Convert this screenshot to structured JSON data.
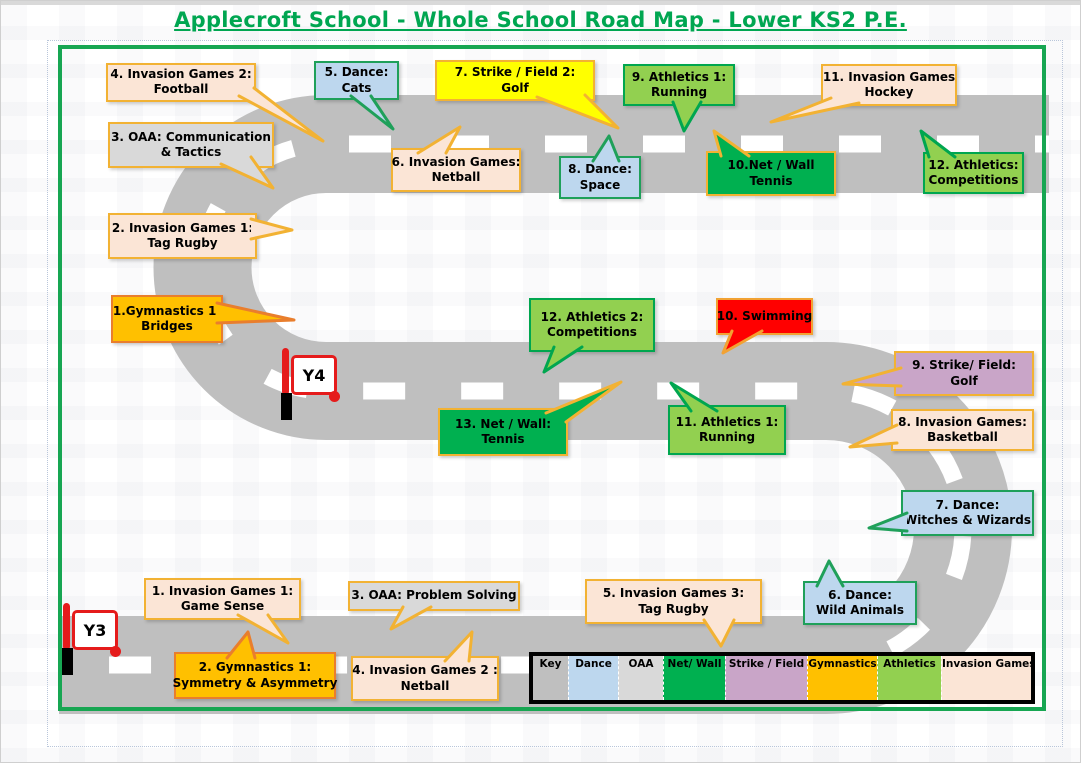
{
  "title": "Applecroft School - Whole School Road Map - Lower KS2 P.E.",
  "colors": {
    "title": "#00A651",
    "map_border": "#17A652",
    "road": "#BFBFBF",
    "road_dash": "#FFFFFF",
    "flag_red": "#E51B1B"
  },
  "categories": {
    "invasion": {
      "label": "Invasion Games",
      "fill": "#FBE5D6",
      "border": "#F2B233"
    },
    "dance": {
      "label": "Dance",
      "fill": "#BDD7EE",
      "border": "#1FA05A"
    },
    "oaa": {
      "label": "OAA",
      "fill": "#D9D9D9",
      "border": "#F2B233"
    },
    "netwall": {
      "label": "Net/ Wall",
      "fill": "#00B050",
      "border": "#F2B233"
    },
    "strike2": {
      "label": "Strike / Field",
      "fill": "#FFFF00",
      "border": "#F2B233"
    },
    "strike": {
      "label": "Strike / Field",
      "fill": "#C9A5C8",
      "border": "#F2B233"
    },
    "gymnastics": {
      "label": "Gymnastics",
      "fill": "#FFC000",
      "border": "#E97E2D"
    },
    "athletics": {
      "label": "Athletics",
      "fill": "#92D050",
      "border": "#00A64F"
    },
    "swimming": {
      "label": "Swimming",
      "fill": "#FF0000",
      "border": "#F2A233"
    }
  },
  "flags": [
    {
      "label": "Y4",
      "x": 281,
      "y": 347
    },
    {
      "label": "Y3",
      "x": 62,
      "y": 602
    }
  ],
  "legend": {
    "items": [
      {
        "label": "Key",
        "fill": "#BFBFBF",
        "w": 35
      },
      {
        "label": "Dance",
        "fill": "#BDD7EE",
        "w": 50
      },
      {
        "label": "OAA",
        "fill": "#D9D9D9",
        "w": 45
      },
      {
        "label": "Net/ Wall",
        "fill": "#00B050",
        "w": 62
      },
      {
        "label": "Strike / Field",
        "fill": "#C9A5C8",
        "w": 82
      },
      {
        "label": "Gymnastics",
        "fill": "#FFC000",
        "w": 70
      },
      {
        "label": "Athletics",
        "fill": "#92D050",
        "w": 64
      },
      {
        "label": "Invasion Games",
        "fill": "#FBE5D6",
        "w": 90
      }
    ]
  },
  "callouts": [
    {
      "id": "invasion-games-2-football",
      "category": "invasion",
      "x": 105,
      "y": 62,
      "w": 150,
      "h": 38,
      "lines": [
        "4. Invasion Games 2:",
        "Football"
      ],
      "tail": [
        238,
        95,
        253,
        87,
        322,
        140
      ]
    },
    {
      "id": "dance-cats",
      "category": "dance",
      "x": 313,
      "y": 60,
      "w": 85,
      "h": 39,
      "lines": [
        "5. Dance:",
        "Cats"
      ],
      "tail": [
        350,
        95,
        370,
        95,
        392,
        128
      ]
    },
    {
      "id": "strike-field-2-golf",
      "category": "strike2",
      "x": 434,
      "y": 59,
      "w": 160,
      "h": 41,
      "lines": [
        "7. Strike / Field 2:",
        "Golf"
      ],
      "tail": [
        536,
        96,
        584,
        94,
        617,
        127
      ]
    },
    {
      "id": "athletics-1-running-top",
      "category": "athletics",
      "x": 622,
      "y": 63,
      "w": 112,
      "h": 42,
      "lines": [
        "9. Athletics 1:",
        "Running"
      ],
      "tail": [
        672,
        101,
        700,
        101,
        683,
        130
      ]
    },
    {
      "id": "invasion-games-hockey",
      "category": "invasion",
      "x": 820,
      "y": 63,
      "w": 136,
      "h": 42,
      "lines": [
        "11. Invasion Games",
        "Hockey"
      ],
      "tail": [
        830,
        97,
        858,
        102,
        770,
        121
      ]
    },
    {
      "id": "oaa-communication-tactics",
      "category": "oaa",
      "x": 107,
      "y": 121,
      "w": 166,
      "h": 46,
      "lines": [
        "3. OAA: Communication",
        "& Tactics"
      ],
      "tail": [
        220,
        163,
        250,
        156,
        272,
        187
      ]
    },
    {
      "id": "invasion-games-netball-top",
      "category": "invasion",
      "x": 390,
      "y": 147,
      "w": 130,
      "h": 44,
      "lines": [
        "6. Invasion Games:",
        "Netball"
      ],
      "tail": [
        417,
        152,
        445,
        152,
        459,
        126
      ]
    },
    {
      "id": "dance-space",
      "category": "dance",
      "x": 558,
      "y": 155,
      "w": 82,
      "h": 43,
      "lines": [
        "8. Dance:",
        "Space"
      ],
      "tail": [
        592,
        160,
        618,
        160,
        608,
        135
      ]
    },
    {
      "id": "net-wall-tennis-top",
      "category": "netwall",
      "x": 705,
      "y": 150,
      "w": 130,
      "h": 45,
      "lines": [
        "10.Net / Wall",
        "Tennis"
      ],
      "tail": [
        720,
        155,
        748,
        155,
        713,
        130
      ]
    },
    {
      "id": "athletics-competitions-top",
      "category": "athletics",
      "x": 922,
      "y": 151,
      "w": 101,
      "h": 42,
      "lines": [
        "12. Athletics:",
        "Competitions"
      ],
      "tail": [
        928,
        156,
        954,
        156,
        920,
        130
      ]
    },
    {
      "id": "invasion-games-1-tag-rugby",
      "category": "invasion",
      "x": 107,
      "y": 212,
      "w": 149,
      "h": 46,
      "lines": [
        "2. Invasion Games 1:",
        "Tag Rugby"
      ],
      "tail": [
        250,
        218,
        250,
        238,
        291,
        229
      ]
    },
    {
      "id": "gymnastics-1-bridges",
      "category": "gymnastics",
      "x": 110,
      "y": 294,
      "w": 112,
      "h": 48,
      "lines": [
        "1.Gymnastics 1:",
        "Bridges"
      ],
      "tail": [
        216,
        302,
        216,
        322,
        293,
        319
      ]
    },
    {
      "id": "athletics-2-competitions",
      "category": "athletics",
      "x": 528,
      "y": 297,
      "w": 126,
      "h": 54,
      "lines": [
        "12. Athletics 2:",
        "Competitions"
      ],
      "tail": [
        553,
        346,
        581,
        346,
        543,
        371
      ]
    },
    {
      "id": "swimming",
      "category": "swimming",
      "x": 715,
      "y": 297,
      "w": 97,
      "h": 37,
      "lines": [
        "10. Swimming"
      ],
      "tail": [
        731,
        330,
        761,
        330,
        722,
        352
      ]
    },
    {
      "id": "strike-field-golf",
      "category": "strike",
      "x": 893,
      "y": 350,
      "w": 140,
      "h": 45,
      "lines": [
        "9. Strike/ Field:",
        "Golf"
      ],
      "tail": [
        900,
        367,
        900,
        385,
        842,
        383
      ]
    },
    {
      "id": "net-wall-tennis-mid",
      "category": "netwall",
      "x": 437,
      "y": 407,
      "w": 130,
      "h": 48,
      "lines": [
        "13. Net / Wall:",
        "Tennis"
      ],
      "tail": [
        545,
        412,
        565,
        421,
        620,
        381
      ]
    },
    {
      "id": "athletics-1-running-mid",
      "category": "athletics",
      "x": 667,
      "y": 404,
      "w": 118,
      "h": 50,
      "lines": [
        "11. Athletics 1:",
        "Running"
      ],
      "tail": [
        690,
        410,
        716,
        410,
        670,
        382
      ]
    },
    {
      "id": "invasion-games-basketball",
      "category": "invasion",
      "x": 890,
      "y": 408,
      "w": 143,
      "h": 42,
      "lines": [
        "8. Invasion Games:",
        "Basketball"
      ],
      "tail": [
        896,
        424,
        896,
        442,
        849,
        446
      ]
    },
    {
      "id": "dance-witches-wizards",
      "category": "dance",
      "x": 900,
      "y": 489,
      "w": 133,
      "h": 46,
      "lines": [
        "7. Dance:",
        "Witches & Wizards"
      ],
      "tail": [
        906,
        512,
        906,
        530,
        868,
        527
      ]
    },
    {
      "id": "invasion-games-1-game-sense",
      "category": "invasion",
      "x": 143,
      "y": 577,
      "w": 157,
      "h": 42,
      "lines": [
        "1. Invasion Games 1:",
        "Game Sense"
      ],
      "tail": [
        237,
        614,
        267,
        614,
        287,
        642
      ]
    },
    {
      "id": "oaa-problem-solving",
      "category": "oaa",
      "x": 347,
      "y": 580,
      "w": 172,
      "h": 30,
      "lines": [
        "3. OAA: Problem Solving"
      ],
      "tail": [
        402,
        606,
        430,
        606,
        390,
        628
      ]
    },
    {
      "id": "invasion-games-3-tag-rugby",
      "category": "invasion",
      "x": 584,
      "y": 578,
      "w": 177,
      "h": 45,
      "lines": [
        "5. Invasion Games 3:",
        "Tag Rugby"
      ],
      "tail": [
        703,
        619,
        733,
        619,
        720,
        645
      ]
    },
    {
      "id": "dance-wild-animals",
      "category": "dance",
      "x": 802,
      "y": 580,
      "w": 114,
      "h": 44,
      "lines": [
        "6. Dance:",
        "Wild Animals"
      ],
      "tail": [
        816,
        585,
        842,
        585,
        828,
        560
      ]
    },
    {
      "id": "gymnastics-1-symmetry",
      "category": "gymnastics",
      "x": 173,
      "y": 651,
      "w": 162,
      "h": 47,
      "lines": [
        "2. Gymnastics 1:",
        "Symmetry & Asymmetry"
      ],
      "tail": [
        226,
        657,
        254,
        657,
        247,
        631
      ]
    },
    {
      "id": "invasion-games-2-netball",
      "category": "invasion",
      "x": 350,
      "y": 655,
      "w": 148,
      "h": 45,
      "lines": [
        "4. Invasion Games 2 :",
        "Netball"
      ],
      "tail": [
        444,
        660,
        468,
        660,
        471,
        631
      ]
    }
  ]
}
